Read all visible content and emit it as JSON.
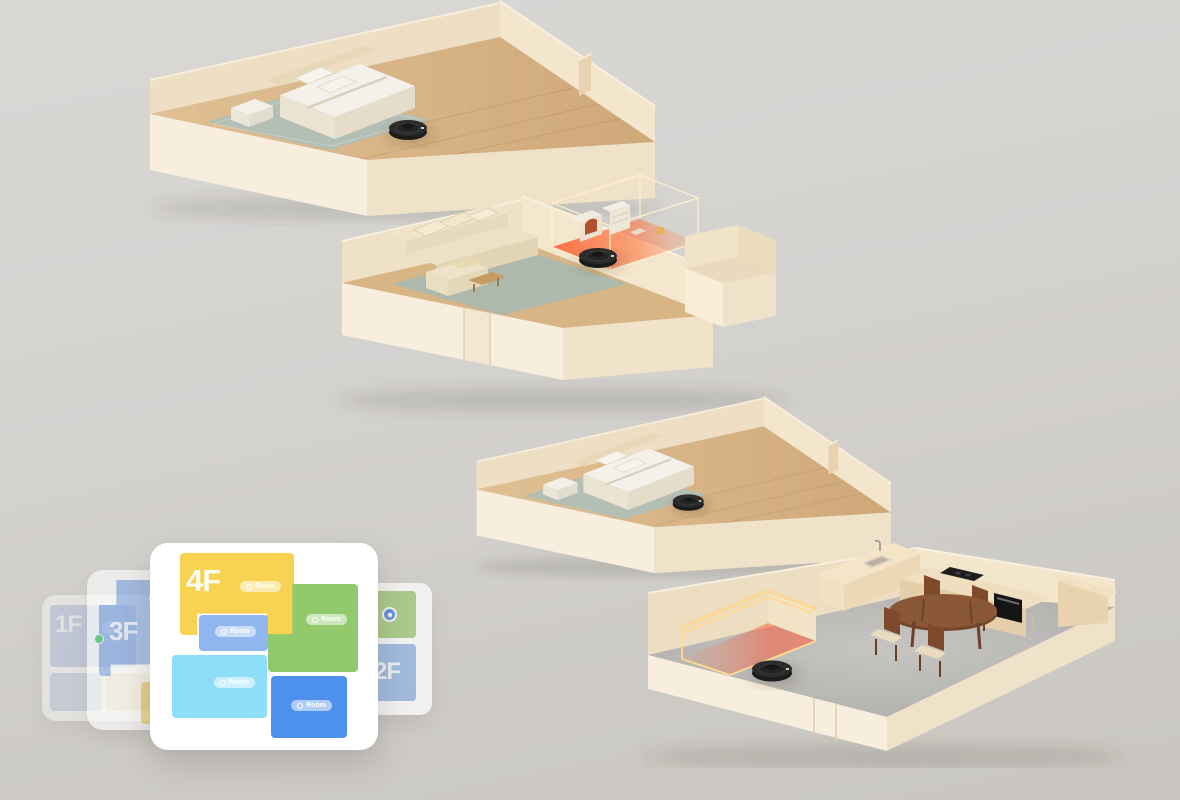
{
  "palette": {
    "background_top": "#dad8d5",
    "background_bottom": "#c9c6c1",
    "wall_cream_light": "#f8eedd",
    "wall_cream_mid": "#efe0c7",
    "wall_cream_dark": "#e7d3b1",
    "wood_floor": "#d8b584",
    "concrete_floor": "#bbb9b6",
    "rug_sage": "#b3bfb4",
    "sofa_beige": "#ece1c5",
    "bed_white": "#f4f1ea",
    "robot_black": "#222222",
    "nogo_zone_orange": "#ff5226",
    "nogo_frame_yellow": "#ffe3a0",
    "card_white": "#ffffff",
    "room_yellow": "#f7d351",
    "room_green": "#92c96c",
    "room_periwinkle": "#8fb6ee",
    "room_cyan": "#8edef9",
    "room_blue": "#4e90ee",
    "accent_blue": "#3b7df0",
    "online_green": "#34c759"
  },
  "map_stack": {
    "cards": [
      {
        "label": "1F"
      },
      {
        "label": "2F"
      },
      {
        "label": "3F"
      },
      {
        "label": "4F"
      }
    ],
    "room_tag": "Room"
  }
}
